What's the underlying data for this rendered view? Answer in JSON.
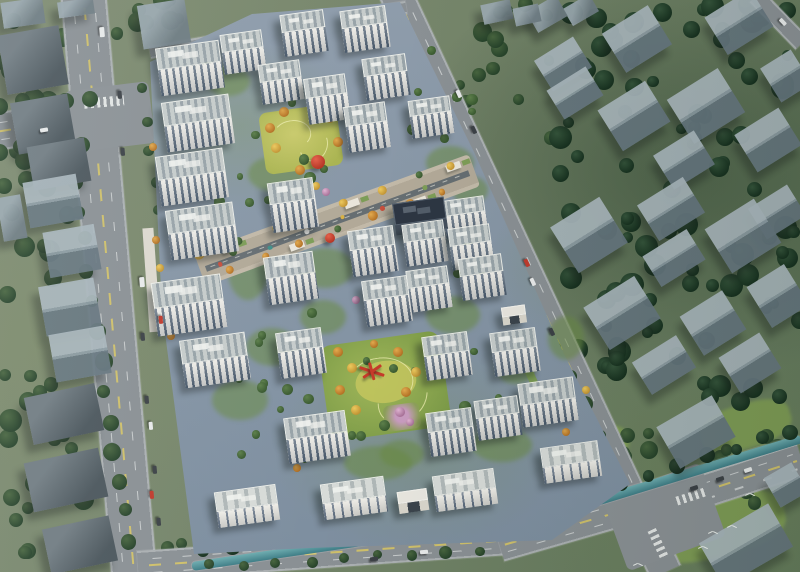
{
  "palette": {
    "background_green": "#75856a",
    "tree_dark": "#2c4733",
    "tree_mid": "#3f5c40",
    "tree_site": "#567a49",
    "road": "#8a9094",
    "road_edge": "#abb0b2",
    "lane_yellow": "#cfc06a",
    "lane_white": "#fafcfa",
    "site_paving": "#8e9cab",
    "context_building": "#6e7c83",
    "context_roof_light": "#a9b6bc",
    "tower_facade": "#e9e7e0",
    "tower_windows": "#4a5b6d",
    "tower_roof_a": "#c6cccb",
    "tower_roof_b": "#98a3a8",
    "dark_building": "#2d3643",
    "lawn_green": "#8ca653",
    "lawn_yellow": "#c2c55e",
    "autumn_tree": "#d69a3e",
    "autumn_tree_2": "#ecc95e",
    "pink_tree": "#e0b3d2",
    "red_accent": "#c63b2a",
    "canal_water": "#4a8a90",
    "shadow": "rgba(22,30,28,0.4)"
  },
  "outer_lawns": [
    [
      636,
      494,
      150,
      64,
      -12
    ],
    [
      700,
      404,
      92,
      44,
      -17
    ],
    [
      560,
      430,
      70,
      36,
      -20
    ]
  ],
  "tree_regions": [
    [
      0,
      0,
      82,
      118,
      10,
      6,
      12,
      11,
      "md"
    ],
    [
      0,
      118,
      76,
      250,
      18,
      6,
      12,
      12,
      "md"
    ],
    [
      0,
      368,
      96,
      200,
      18,
      6,
      12,
      13,
      "md"
    ],
    [
      112,
      0,
      76,
      52,
      8,
      5,
      10,
      14,
      "md"
    ],
    [
      455,
      18,
      100,
      140,
      11,
      5,
      10,
      15,
      "md"
    ],
    [
      480,
      0,
      72,
      30,
      5,
      5,
      8,
      16,
      "md"
    ],
    [
      556,
      0,
      244,
      205,
      46,
      5,
      12,
      17,
      "dk"
    ],
    [
      558,
      205,
      242,
      200,
      50,
      5,
      12,
      18,
      "dk"
    ],
    [
      612,
      428,
      188,
      76,
      16,
      5,
      10,
      19,
      "md"
    ],
    [
      118,
      535,
      66,
      34,
      6,
      5,
      8,
      20,
      "md"
    ]
  ],
  "site_tree_regions": [
    [
      205,
      35,
      275,
      300,
      30,
      3,
      6,
      21,
      "st"
    ],
    [
      225,
      335,
      305,
      150,
      24,
      3,
      6,
      22,
      "st"
    ]
  ],
  "tree_rows": [
    [
      143,
      90,
      175,
      330,
      9,
      6,
      "md"
    ],
    [
      75,
      180,
      128,
      540,
      13,
      8,
      "md"
    ],
    [
      168,
      58,
      360,
      20,
      8,
      5,
      "md"
    ],
    [
      468,
      175,
      612,
      462,
      11,
      7,
      "md"
    ],
    [
      200,
      548,
      556,
      500,
      13,
      7,
      "dk"
    ],
    [
      566,
      500,
      790,
      432,
      9,
      7,
      "dk"
    ],
    [
      210,
      566,
      480,
      550,
      9,
      6,
      "md"
    ],
    [
      0,
      106,
      88,
      96,
      5,
      7,
      "md"
    ],
    [
      0,
      152,
      80,
      142,
      5,
      7,
      "md"
    ]
  ],
  "single_trees": [
    [
      284,
      112,
      5,
      "a"
    ],
    [
      270,
      128,
      5,
      "a"
    ],
    [
      276,
      148,
      5,
      "a2"
    ],
    [
      300,
      170,
      5,
      "a"
    ],
    [
      330,
      118,
      5,
      "a2"
    ],
    [
      338,
      142,
      5,
      "a"
    ],
    [
      316,
      186,
      4,
      "a2"
    ],
    [
      338,
      352,
      5,
      "a"
    ],
    [
      352,
      368,
      5,
      "a2"
    ],
    [
      340,
      390,
      5,
      "a"
    ],
    [
      356,
      410,
      5,
      "a2"
    ],
    [
      398,
      352,
      5,
      "a"
    ],
    [
      416,
      372,
      5,
      "a2"
    ],
    [
      406,
      392,
      5,
      "a"
    ],
    [
      374,
      344,
      4,
      "a"
    ],
    [
      156,
      240,
      4,
      "a"
    ],
    [
      160,
      268,
      4,
      "a2"
    ],
    [
      163,
      292,
      4,
      "a"
    ],
    [
      167,
      314,
      4,
      "a2"
    ],
    [
      171,
      336,
      4,
      "a"
    ],
    [
      376,
      130,
      5,
      "p"
    ],
    [
      326,
      192,
      4,
      "p"
    ],
    [
      400,
      412,
      5,
      "p"
    ],
    [
      410,
      422,
      4,
      "p"
    ],
    [
      356,
      300,
      4,
      "p"
    ],
    [
      297,
      468,
      4,
      "a"
    ],
    [
      586,
      390,
      4,
      "a2"
    ],
    [
      153,
      147,
      4,
      "a"
    ],
    [
      566,
      432,
      4,
      "a"
    ]
  ],
  "roads": [
    [
      83,
      -10,
      600,
      46,
      85,
      "main"
    ],
    [
      -5,
      132,
      125,
      38,
      -9,
      "main"
    ],
    [
      395,
      -8,
      640,
      34,
      65,
      "main"
    ],
    [
      150,
      52,
      260,
      13,
      -10,
      "minor"
    ],
    [
      138,
      566,
      370,
      30,
      -4,
      "main"
    ],
    [
      500,
      546,
      150,
      32,
      -16,
      "main"
    ],
    [
      640,
      512,
      170,
      34,
      -18,
      "main"
    ],
    [
      756,
      -4,
      66,
      18,
      46,
      "minor"
    ]
  ],
  "road_patches": [
    [
      68,
      86,
      84,
      62,
      -7
    ],
    [
      612,
      478,
      104,
      78,
      -20
    ]
  ],
  "crosswalks": [
    [
      84,
      97,
      40,
      10,
      -5
    ],
    [
      676,
      492,
      30,
      9,
      -18
    ],
    [
      643,
      539,
      30,
      9,
      65
    ]
  ],
  "canal": [
    [
      192,
      566,
      372,
      9,
      -8.4
    ],
    [
      560,
      512,
      252,
      9,
      -17
    ]
  ],
  "context_buildings": [
    [
      2,
      0,
      42,
      26,
      -8,
      "f"
    ],
    [
      58,
      0,
      36,
      16,
      -8,
      "f"
    ],
    [
      2,
      30,
      62,
      60,
      -10,
      "d"
    ],
    [
      140,
      2,
      48,
      44,
      -9,
      "f"
    ],
    [
      14,
      98,
      58,
      52,
      -10,
      "d"
    ],
    [
      30,
      142,
      58,
      44,
      -10,
      "d"
    ],
    [
      26,
      178,
      54,
      46,
      -10,
      "g"
    ],
    [
      46,
      228,
      52,
      46,
      -10,
      "g"
    ],
    [
      42,
      282,
      56,
      50,
      -10,
      "g"
    ],
    [
      52,
      330,
      56,
      48,
      -10,
      "g"
    ],
    [
      0,
      196,
      24,
      44,
      -10,
      "f"
    ],
    [
      28,
      390,
      72,
      48,
      -12,
      "d"
    ],
    [
      28,
      455,
      76,
      50,
      -12,
      "d"
    ],
    [
      46,
      522,
      68,
      46,
      -12,
      "d"
    ],
    [
      530,
      2,
      34,
      24,
      -30,
      "f"
    ],
    [
      566,
      0,
      30,
      20,
      -30,
      "f"
    ],
    [
      482,
      2,
      30,
      20,
      -12,
      "f"
    ],
    [
      514,
      6,
      26,
      18,
      -12,
      "f"
    ],
    [
      610,
      16,
      54,
      46,
      -32,
      "g"
    ],
    [
      712,
      0,
      54,
      44,
      -32,
      "g"
    ],
    [
      540,
      46,
      46,
      36,
      -32,
      "g"
    ],
    [
      552,
      76,
      46,
      34,
      -32,
      "g"
    ],
    [
      676,
      80,
      60,
      52,
      -32,
      "g"
    ],
    [
      606,
      92,
      56,
      48,
      -32,
      "g"
    ],
    [
      742,
      118,
      52,
      44,
      -32,
      "g"
    ],
    [
      768,
      56,
      36,
      40,
      -32,
      "g"
    ],
    [
      660,
      140,
      48,
      40,
      -32,
      "g"
    ],
    [
      560,
      208,
      58,
      54,
      -32,
      "g"
    ],
    [
      644,
      188,
      54,
      42,
      -32,
      "g"
    ],
    [
      648,
      240,
      52,
      36,
      -32,
      "g"
    ],
    [
      714,
      210,
      58,
      52,
      -32,
      "g"
    ],
    [
      754,
      194,
      46,
      36,
      -32,
      "g"
    ],
    [
      592,
      288,
      60,
      50,
      -32,
      "g"
    ],
    [
      688,
      300,
      50,
      46,
      -32,
      "g"
    ],
    [
      756,
      272,
      44,
      48,
      -32,
      "g"
    ],
    [
      638,
      346,
      52,
      38,
      -32,
      "g"
    ],
    [
      726,
      342,
      48,
      42,
      -32,
      "g"
    ],
    [
      664,
      408,
      64,
      48,
      -30,
      "g"
    ],
    [
      706,
      520,
      80,
      50,
      -30,
      "g"
    ],
    [
      770,
      468,
      32,
      34,
      -30,
      "g"
    ]
  ],
  "site": {
    "poly": [
      [
        150,
        62
      ],
      [
        252,
        14
      ],
      [
        400,
        2
      ],
      [
        474,
        152
      ],
      [
        564,
        354
      ],
      [
        630,
        484
      ],
      [
        552,
        540
      ],
      [
        310,
        548
      ],
      [
        194,
        554
      ],
      [
        162,
        310
      ]
    ],
    "greens": [
      [
        206,
        66,
        44,
        30
      ],
      [
        248,
        156,
        56,
        36
      ],
      [
        426,
        146,
        48,
        34
      ],
      [
        296,
        248,
        58,
        40
      ],
      [
        426,
        296,
        54,
        38
      ],
      [
        246,
        328,
        52,
        38
      ],
      [
        496,
        352,
        40,
        32
      ],
      [
        344,
        446,
        68,
        34
      ],
      [
        472,
        428,
        60,
        34
      ],
      [
        548,
        316,
        36,
        44
      ],
      [
        228,
        240,
        40,
        60
      ],
      [
        300,
        300,
        46,
        34
      ],
      [
        452,
        176,
        36,
        28
      ],
      [
        212,
        380,
        56,
        40
      ],
      [
        380,
        440,
        44,
        28
      ]
    ],
    "strips": [
      [
        470,
        236,
        8,
        40,
        -25,
        "g"
      ],
      [
        526,
        350,
        8,
        48,
        -25,
        "g"
      ],
      [
        146,
        228,
        11,
        104,
        -4,
        "w"
      ]
    ],
    "lawn_north": [
      262,
      108,
      78,
      62,
      -8
    ],
    "lawn_central": [
      324,
      338,
      122,
      96,
      -8
    ],
    "flower_garden": [
      384,
      404,
      36,
      26,
      -8
    ],
    "street": {
      "x": 200,
      "y": 270,
      "len": 292,
      "w": 34,
      "rot": -20,
      "seed": 7,
      "pavilions": [
        28,
        92,
        158,
        222,
        266
      ],
      "umbrella_colors": [
        "#c8503e",
        "#3f8f8a",
        "#e8e8e6",
        "#d9b244",
        "#c8503e",
        "#7d9d57"
      ]
    },
    "towers": [
      [
        158,
        44,
        64,
        22,
        26,
        "slab"
      ],
      [
        164,
        98,
        68,
        24,
        26,
        "slab"
      ],
      [
        158,
        152,
        68,
        24,
        26,
        "slab"
      ],
      [
        168,
        206,
        68,
        24,
        26,
        "slab"
      ],
      [
        154,
        278,
        70,
        26,
        28,
        "slab"
      ],
      [
        182,
        336,
        66,
        24,
        24,
        "slab"
      ],
      [
        222,
        32,
        42,
        18,
        22,
        "t"
      ],
      [
        282,
        12,
        44,
        18,
        24,
        "t"
      ],
      [
        342,
        8,
        46,
        18,
        24,
        "t"
      ],
      [
        364,
        56,
        44,
        18,
        24,
        "t"
      ],
      [
        260,
        62,
        42,
        18,
        22,
        "t"
      ],
      [
        306,
        76,
        42,
        20,
        26,
        "t"
      ],
      [
        410,
        98,
        42,
        16,
        22,
        "t"
      ],
      [
        346,
        104,
        42,
        20,
        26,
        "t"
      ],
      [
        270,
        180,
        46,
        22,
        28,
        "t"
      ],
      [
        350,
        228,
        46,
        20,
        26,
        "t"
      ],
      [
        404,
        222,
        42,
        18,
        24,
        "t"
      ],
      [
        444,
        198,
        42,
        16,
        22,
        "t"
      ],
      [
        450,
        226,
        42,
        18,
        24,
        "t"
      ],
      [
        266,
        254,
        50,
        22,
        26,
        "t"
      ],
      [
        364,
        278,
        46,
        20,
        26,
        "t"
      ],
      [
        408,
        268,
        42,
        18,
        24,
        "t"
      ],
      [
        460,
        256,
        44,
        18,
        24,
        "t"
      ],
      [
        278,
        330,
        46,
        20,
        26,
        "t"
      ],
      [
        424,
        334,
        46,
        20,
        24,
        "t"
      ],
      [
        492,
        330,
        46,
        20,
        24,
        "t"
      ],
      [
        286,
        414,
        62,
        22,
        24,
        "slab"
      ],
      [
        428,
        410,
        46,
        20,
        24,
        "t"
      ],
      [
        476,
        398,
        44,
        18,
        22,
        "t"
      ],
      [
        520,
        380,
        56,
        22,
        22,
        "slab"
      ],
      [
        216,
        488,
        62,
        20,
        16,
        "low"
      ],
      [
        322,
        480,
        64,
        20,
        16,
        "low"
      ],
      [
        434,
        472,
        62,
        20,
        16,
        "low"
      ],
      [
        542,
        444,
        58,
        20,
        16,
        "low"
      ],
      [
        394,
        200,
        52,
        22,
        10,
        "dark"
      ],
      [
        398,
        490,
        30,
        12,
        10,
        "gate"
      ],
      [
        502,
        306,
        24,
        10,
        8,
        "gate"
      ]
    ],
    "sculptures": [
      {
        "t": "ball",
        "x": 318,
        "y": 162,
        "r": 7
      },
      {
        "t": "ball",
        "x": 330,
        "y": 238,
        "r": 5
      },
      {
        "t": "lines",
        "x": 372,
        "y": 370,
        "bars": [
          [
            26,
            18
          ],
          [
            22,
            -35
          ],
          [
            18,
            75
          ]
        ]
      }
    ]
  },
  "cars": [
    [
      97,
      30,
      85,
      "w",
      1.3
    ],
    [
      116,
      93,
      85,
      "d",
      1
    ],
    [
      119,
      150,
      85,
      "d",
      1
    ],
    [
      137,
      280,
      85,
      "w",
      1.3
    ],
    [
      139,
      335,
      85,
      "d",
      1
    ],
    [
      157,
      318,
      85,
      "r",
      1
    ],
    [
      143,
      398,
      85,
      "d",
      1
    ],
    [
      147,
      424,
      85,
      "w",
      1
    ],
    [
      151,
      468,
      85,
      "d",
      1
    ],
    [
      148,
      493,
      85,
      "r",
      1
    ],
    [
      155,
      520,
      85,
      "d",
      1
    ],
    [
      40,
      128,
      -9,
      "w",
      1
    ],
    [
      455,
      92,
      65,
      "w",
      1
    ],
    [
      470,
      128,
      65,
      "d",
      1
    ],
    [
      523,
      261,
      65,
      "r",
      1
    ],
    [
      529,
      280,
      65,
      "w",
      1
    ],
    [
      548,
      330,
      65,
      "d",
      1
    ],
    [
      690,
      486,
      -18,
      "d",
      1
    ],
    [
      716,
      477,
      -18,
      "d",
      1
    ],
    [
      744,
      468,
      -18,
      "w",
      1
    ],
    [
      370,
      557,
      -4,
      "d",
      1
    ],
    [
      420,
      550,
      -4,
      "w",
      1
    ],
    [
      779,
      20,
      46,
      "w",
      1
    ]
  ],
  "birds": [
    [
      708,
      530
    ],
    [
      727,
      524
    ],
    [
      698,
      545
    ],
    [
      745,
      492
    ],
    [
      633,
      562
    ]
  ]
}
